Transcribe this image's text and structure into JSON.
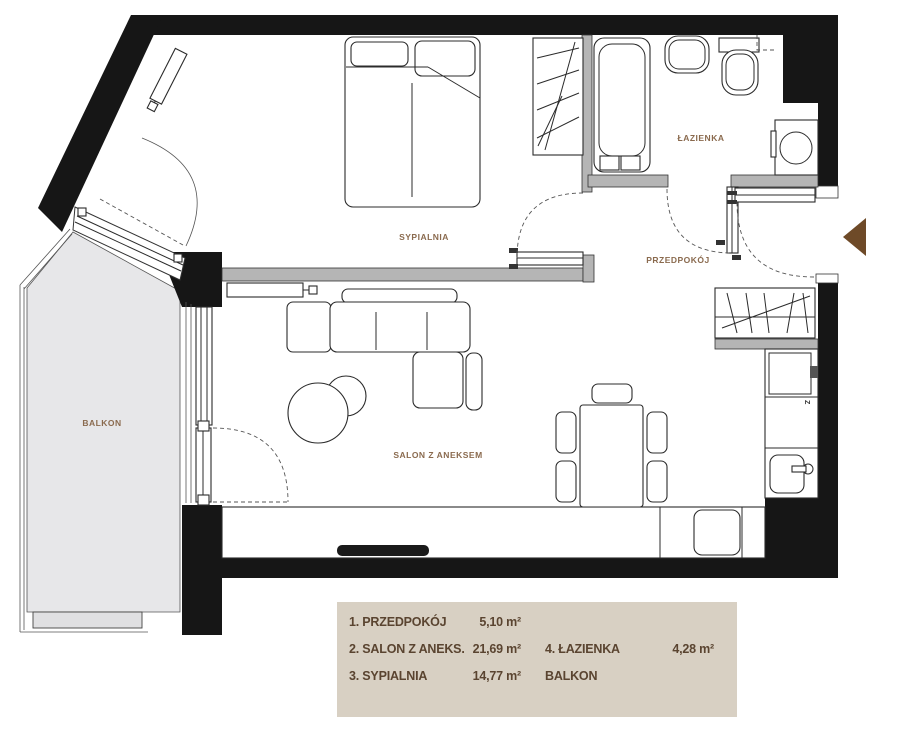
{
  "plan": {
    "rooms": {
      "bedroom": {
        "label": "SYPIALNIA"
      },
      "living": {
        "label": "SALON Z ANEKSEM"
      },
      "bathroom": {
        "label": "ŁAZIENKA"
      },
      "hallway": {
        "label": "PRZEDPOKÓJ"
      },
      "balcony": {
        "label": "BALKON"
      }
    },
    "markers": {
      "fridge": "Z"
    },
    "colors": {
      "wall_black": "#161616",
      "partition_gray": "#b5b5b5",
      "balcony_gray": "#e7e7e9",
      "label_brown": "#8a6a4e",
      "entrance_arrow_brown": "#6e4a28",
      "legend_background": "#d8d0c3",
      "legend_text": "#5a4430"
    }
  },
  "legend": {
    "items": [
      {
        "label": "1. PRZEDPOKÓJ",
        "area": "5,10 m²"
      },
      {
        "label": "2. SALON Z ANEKS.",
        "area": "21,69 m²"
      },
      {
        "label": "3. SYPIALNIA",
        "area": "14,77 m²"
      },
      {
        "label": "4. ŁAZIENKA",
        "area": "4,28 m²"
      },
      {
        "label": "BALKON",
        "area": ""
      }
    ]
  }
}
